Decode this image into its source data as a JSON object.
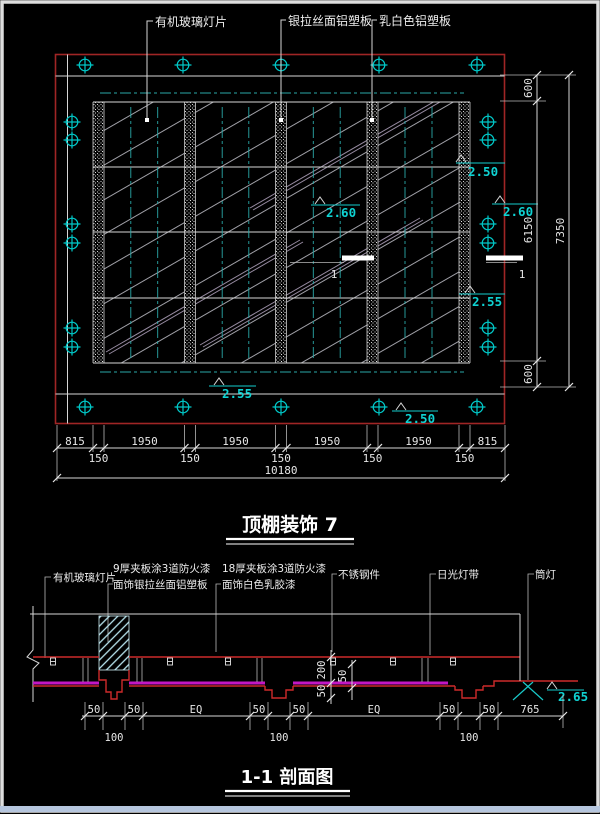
{
  "colors": {
    "background": "#000000",
    "plan_border_red": "#a02525",
    "section_red": "#cd2a2a",
    "magenta_line": "#c316c3",
    "cyan_symbols": "#00c8c8",
    "elevation_cyan": "#0fd2d2",
    "line_white": "#d6d6d6"
  },
  "plan": {
    "title": "顶棚装饰 7",
    "callouts": [
      "有机玻璃灯片",
      "银拉丝面铝塑板",
      "乳白色铝塑板"
    ],
    "cut_label": "1",
    "elevations": [
      "2.50",
      "2.60",
      "2.60",
      "2.55",
      "2.55",
      "2.50"
    ],
    "dims_right": [
      "600",
      "6150",
      "600"
    ],
    "dims_right_total": "7350",
    "dims_bottom_row1": [
      "815",
      "1950",
      "1950",
      "1950",
      "1950",
      "815"
    ],
    "dims_bottom_row2": [
      "150",
      "150",
      "150",
      "150",
      "150"
    ],
    "dims_bottom_total": "10180"
  },
  "section": {
    "title": "1-1 剖面图",
    "callouts": [
      [
        "有机玻璃灯片",
        ""
      ],
      [
        "9厚夹板涂3道防火漆",
        "面饰银拉丝面铝塑板"
      ],
      [
        "18厚夹板涂3道防火漆",
        "面饰白色乳胶漆"
      ],
      [
        "不锈钢件",
        ""
      ],
      [
        "日光灯带",
        ""
      ],
      [
        "筒灯",
        ""
      ]
    ],
    "elevation": "2.65",
    "dims_bottom": {
      "fifty": "50",
      "hundred": "100",
      "eq": "EQ",
      "end": "765"
    },
    "dims_vertical": {
      "two_hundred": "200",
      "fifty": "50"
    }
  }
}
